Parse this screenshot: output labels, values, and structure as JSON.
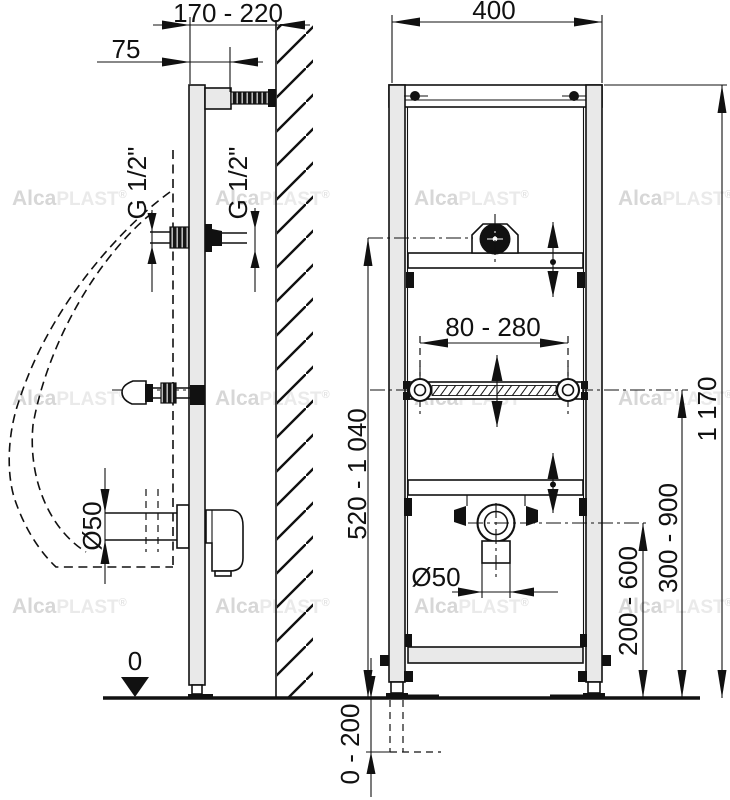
{
  "drawing": {
    "dims": {
      "depth_range": "170 - 220",
      "bracket_offset": "75",
      "frame_width": "400",
      "fixing_span": "80 - 280",
      "inlet_height_range": "520 - 1 040",
      "frame_height": "1 170",
      "fixing_height_range": "300 - 900",
      "drain_height_range": "200 - 600",
      "floor_adjust_range": "0 - 200",
      "floor_level": "0",
      "drain_diameter": "Ø50",
      "thread_size": "G 1/2\""
    },
    "watermark": {
      "alca": "Alca",
      "plast": "PLAST",
      "reg": "®"
    },
    "colors": {
      "line": "#111111",
      "metal_fill": "#e9e9e9",
      "watermark_gray": "#d7d7d7",
      "background": "#ffffff"
    }
  }
}
